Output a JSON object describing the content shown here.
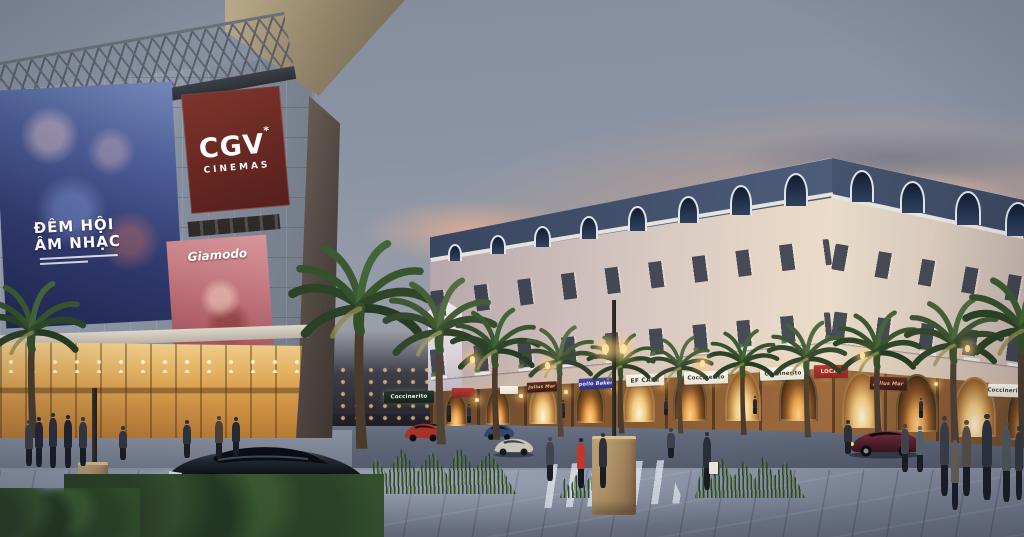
{
  "scene": {
    "description": "Dusk architectural rendering: CGV Cinemas mall with glass facade and movie posters on the left, French-style shophouse row with mansard roofs and arched arcade shops on the right, palm-lined street with cars, crosswalk and pedestrians."
  },
  "cinema_sign": {
    "brand": "CGV",
    "star": "*",
    "word": "CINEMAS",
    "bg": "#6b2a24",
    "text_color": "#ffffff"
  },
  "posters": {
    "music": {
      "line1": "ĐÊM HỘI",
      "line2": "ÂM NHẠC"
    },
    "promo": {
      "brand": "Giamodo"
    }
  },
  "shops": {
    "items": [
      {
        "label": "Coccinerito",
        "style": "dark"
      },
      {
        "label": "Julius Mar",
        "style": "maroon"
      },
      {
        "label": "Apollo Bakery",
        "style": "blue"
      },
      {
        "label": "EF CAFÉ",
        "style": "light"
      },
      {
        "label": "Coccinerito",
        "style": "light"
      },
      {
        "label": "Coccinerito",
        "style": "light"
      },
      {
        "label": "LOCAL",
        "style": "red"
      },
      {
        "label": "Julius Mar",
        "style": "maroon"
      },
      {
        "label": "Coccinerito",
        "style": "light"
      }
    ]
  },
  "vehicles": [
    {
      "name": "black-sedan",
      "color": "#15181d"
    },
    {
      "name": "red-car",
      "color": "#a83227"
    },
    {
      "name": "blue-car",
      "color": "#31496b"
    },
    {
      "name": "silver-car",
      "color": "#c9c4b8"
    },
    {
      "name": "maroon-sedan",
      "color": "#5e202b"
    }
  ],
  "palette": {
    "sky_top": "#848d9c",
    "sunset_glow": "#e8b497",
    "sunset_cloud": "#5f6a80",
    "cgv_sign_bg": "#6b2a24",
    "mall_glass": "#8a94a4",
    "mall_interior_glow": "#e2ae5e",
    "mansard_roof": "#42506b",
    "facade_cream": "#e6d7c6",
    "arcade_warm": "#84572f",
    "arch_glow": "#ffd184",
    "lamp_glow": "#ffd98e",
    "palm_green": "#35512c",
    "street": "#596274",
    "plaza": "#7c8597",
    "sign_light_bg": "#f2eee2",
    "sign_dark_bg": "#1c2a20",
    "sign_red_bg": "#a62c2c",
    "sign_blue_bg": "#3c3c9a",
    "sign_maroon_bg": "#4f241d"
  }
}
